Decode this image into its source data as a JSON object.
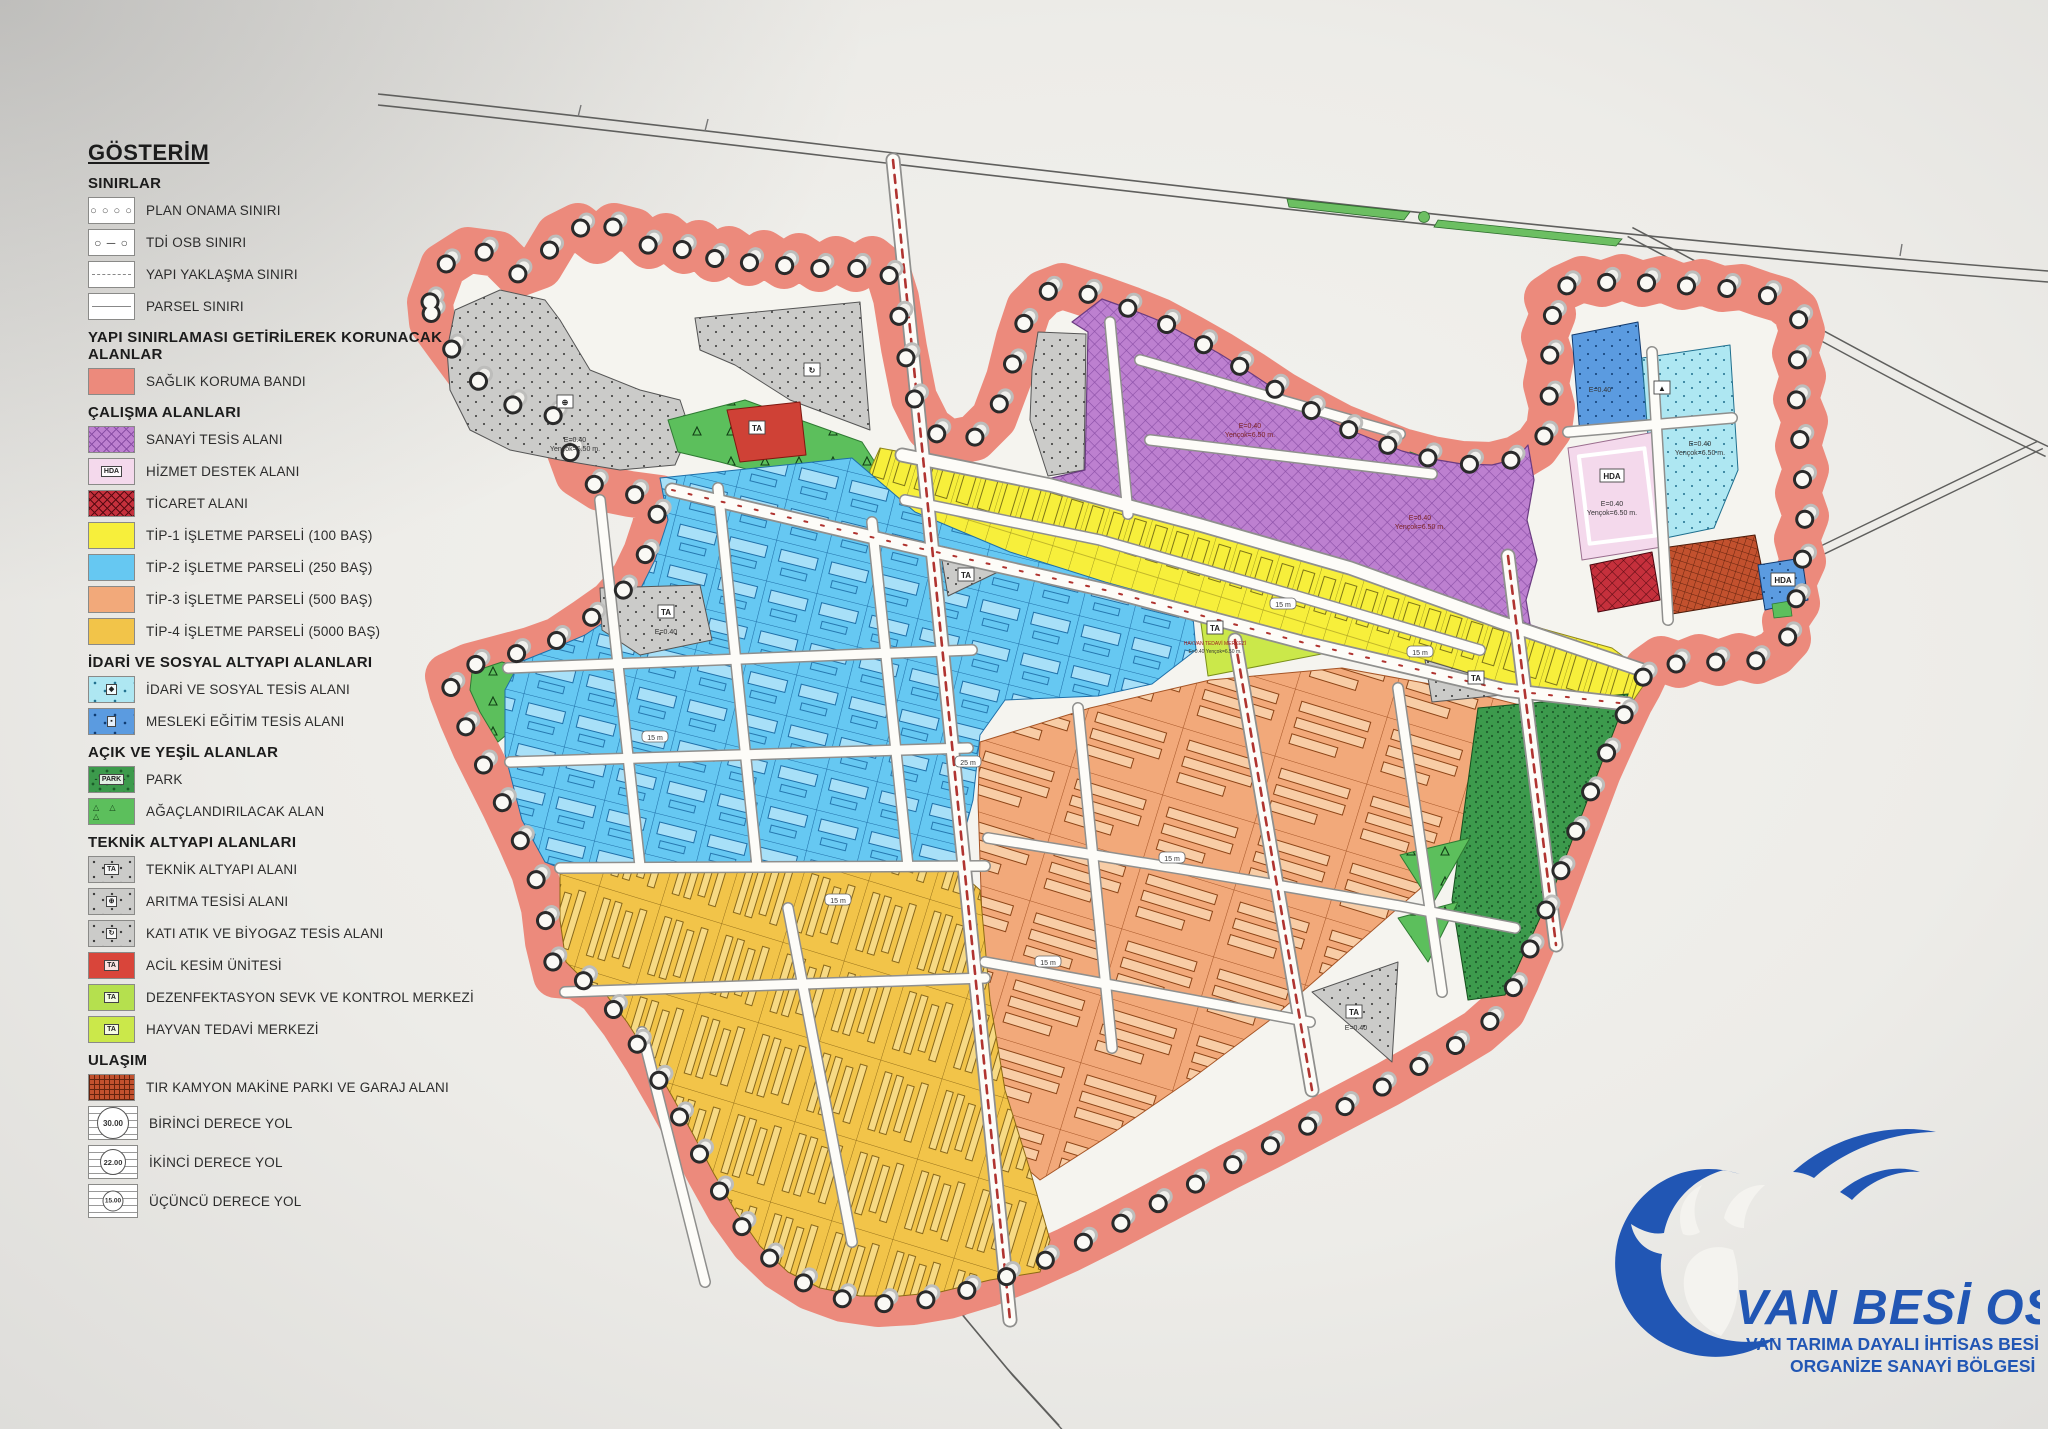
{
  "legend": {
    "title": "GÖSTERİM",
    "sections": [
      {
        "heading": "SINIRLAR",
        "items": [
          {
            "label": "PLAN ONAMA SINIRI",
            "swatch": "plan-onama"
          },
          {
            "label": "TDİ OSB SINIRI",
            "swatch": "tdi-osb"
          },
          {
            "label": "YAPI YAKLAŞMA SINIRI",
            "swatch": "yapi-yaklasma"
          },
          {
            "label": "PARSEL SINIRI",
            "swatch": "parsel"
          }
        ]
      },
      {
        "heading": "YAPI SINIRLAMASI GETİRİLEREK KORUNACAK ALANLAR",
        "items": [
          {
            "label": "SAĞLIK KORUMA BANDI",
            "swatch": "saglik"
          }
        ]
      },
      {
        "heading": "ÇALIŞMA ALANLARI",
        "items": [
          {
            "label": "SANAYİ TESİS ALANI",
            "swatch": "sanayi"
          },
          {
            "label": "HİZMET DESTEK ALANI",
            "swatch": "hizmet",
            "badge": "HDA"
          },
          {
            "label": "TİCARET ALANI",
            "swatch": "ticaret"
          },
          {
            "label": "TİP-1 İŞLETME PARSELİ (100 BAŞ)",
            "swatch": "tip1"
          },
          {
            "label": "TİP-2 İŞLETME PARSELİ (250 BAŞ)",
            "swatch": "tip2"
          },
          {
            "label": "TİP-3 İŞLETME PARSELİ (500 BAŞ)",
            "swatch": "tip3"
          },
          {
            "label": "TİP-4 İŞLETME PARSELİ (5000 BAŞ)",
            "swatch": "tip4"
          }
        ]
      },
      {
        "heading": "İDARİ VE SOSYAL ALTYAPI ALANLARI",
        "items": [
          {
            "label": "İDARİ VE SOSYAL TESİS ALANI",
            "swatch": "idari",
            "badge": "◆"
          },
          {
            "label": "MESLEKİ EĞİTİM TESİS ALANI",
            "swatch": "mesleki",
            "badge": "▪"
          }
        ]
      },
      {
        "heading": "AÇIK VE YEŞİL ALANLAR",
        "items": [
          {
            "label": "PARK",
            "swatch": "park",
            "badge": "PARK"
          },
          {
            "label": "AĞAÇLANDIRILACAK ALAN",
            "swatch": "agac"
          }
        ]
      },
      {
        "heading": "TEKNİK ALTYAPI ALANLARI",
        "items": [
          {
            "label": "TEKNİK ALTYAPI ALANI",
            "swatch": "teknik",
            "badge": "TA"
          },
          {
            "label": "ARITMA TESİSİ ALANI",
            "swatch": "aritma",
            "badge": "⊕"
          },
          {
            "label": "KATI ATIK VE BİYOGAZ TESİS ALANI",
            "swatch": "kati",
            "badge": "↻"
          },
          {
            "label": "ACİL KESİM ÜNİTESİ",
            "swatch": "acil",
            "badge": "TA"
          },
          {
            "label": "DEZENFEKTASYON SEVK VE KONTROL MERKEZİ",
            "swatch": "dezenf",
            "badge": "TA"
          },
          {
            "label": "HAYVAN TEDAVİ MERKEZİ",
            "swatch": "hayvan",
            "badge": "TA"
          }
        ]
      },
      {
        "heading": "ULAŞIM",
        "items": [
          {
            "label": "TIR KAMYON MAKİNE PARKI VE GARAJ ALANI",
            "swatch": "tir"
          },
          {
            "label": "BİRİNCİ DERECE YOL",
            "swatch": "road",
            "road_no": "30.00",
            "road_class": "rc-1"
          },
          {
            "label": "İKİNCİ DERECE YOL",
            "swatch": "road",
            "road_no": "22.00",
            "road_class": "rc-2"
          },
          {
            "label": "ÜÇÜNCÜ DERECE YOL",
            "swatch": "road",
            "road_no": "15.00",
            "road_class": "rc-3"
          }
        ]
      }
    ]
  },
  "logo": {
    "name": "VAN BESİ OSB",
    "subtitle_1": "VAN TARIMA DAYALI İHTİSAS BESİ",
    "subtitle_2": "ORGANİZE SANAYİ BÖLGESİ",
    "color": "#2156b4"
  },
  "map": {
    "boxes": [
      {
        "x": 666,
        "y": 612,
        "t": "TA"
      },
      {
        "x": 966,
        "y": 575,
        "t": "TA"
      },
      {
        "x": 1215,
        "y": 628,
        "t": "TA"
      },
      {
        "x": 1476,
        "y": 678,
        "t": "TA"
      },
      {
        "x": 1354,
        "y": 1012,
        "t": "TA"
      },
      {
        "x": 757,
        "y": 428,
        "t": "TA"
      },
      {
        "x": 1612,
        "y": 476,
        "t": "HDA"
      },
      {
        "x": 1783,
        "y": 580,
        "t": "HDA"
      },
      {
        "x": 565,
        "y": 402,
        "t": "⊕"
      },
      {
        "x": 812,
        "y": 370,
        "t": "↻"
      },
      {
        "x": 1662,
        "y": 388,
        "t": "▲"
      }
    ],
    "notes": [
      {
        "x": 575,
        "y": 442,
        "lines": [
          "E=0.40",
          "Yençok=6.50 m."
        ]
      },
      {
        "x": 666,
        "y": 634,
        "lines": [
          "E=0.40"
        ]
      },
      {
        "x": 1250,
        "y": 428,
        "lines": [
          "E=0.40",
          "Yençok=6.50 m."
        ],
        "c": "#7a1f1f"
      },
      {
        "x": 1420,
        "y": 520,
        "lines": [
          "E=0.40",
          "Yençok=6.50 m."
        ],
        "c": "#7a1f1f"
      },
      {
        "x": 1612,
        "y": 506,
        "lines": [
          "E=0.40",
          "Yençok=6.50 m."
        ]
      },
      {
        "x": 1700,
        "y": 446,
        "lines": [
          "E=0.40",
          "Yençok=6.50 m."
        ]
      },
      {
        "x": 1600,
        "y": 392,
        "lines": [
          "E=0.40"
        ]
      },
      {
        "x": 1356,
        "y": 1030,
        "lines": [
          "E=0.40"
        ]
      },
      {
        "x": 1215,
        "y": 645,
        "lines": [
          "HAYVAN TEDAVİ MERKEZİ"
        ],
        "c": "#a02020",
        "s": 5
      },
      {
        "x": 1215,
        "y": 653,
        "lines": [
          "E=0.40  Yençok=6.50 m."
        ],
        "s": 5
      }
    ],
    "chips": [
      {
        "x": 1283,
        "y": 604,
        "t": "15 m"
      },
      {
        "x": 838,
        "y": 900,
        "t": "15 m"
      },
      {
        "x": 1172,
        "y": 858,
        "t": "15 m"
      },
      {
        "x": 1048,
        "y": 962,
        "t": "15 m"
      },
      {
        "x": 655,
        "y": 737,
        "t": "15 m"
      },
      {
        "x": 968,
        "y": 762,
        "t": "25 m"
      },
      {
        "x": 1420,
        "y": 652,
        "t": "15 m"
      }
    ]
  },
  "colors": {
    "saglik_band": "#ec8a7c",
    "sanayi": "#bd80d0",
    "tip1": "#f7ef3b",
    "tip2": "#66c8f2",
    "tip3": "#f2a97a",
    "tip4": "#f2c449",
    "park": "#3c9a4c",
    "agac": "#5cbf5c",
    "teknik": "#cbcbc9",
    "idari": "#aee7f2",
    "mesleki": "#5b9be0",
    "hizmet": "#f4d9ec",
    "ticaret": "#c5303c",
    "tir": "#c2512e",
    "acil": "#cf4136",
    "hayvan": "#cbe84a",
    "logo_blue": "#2156b4"
  }
}
